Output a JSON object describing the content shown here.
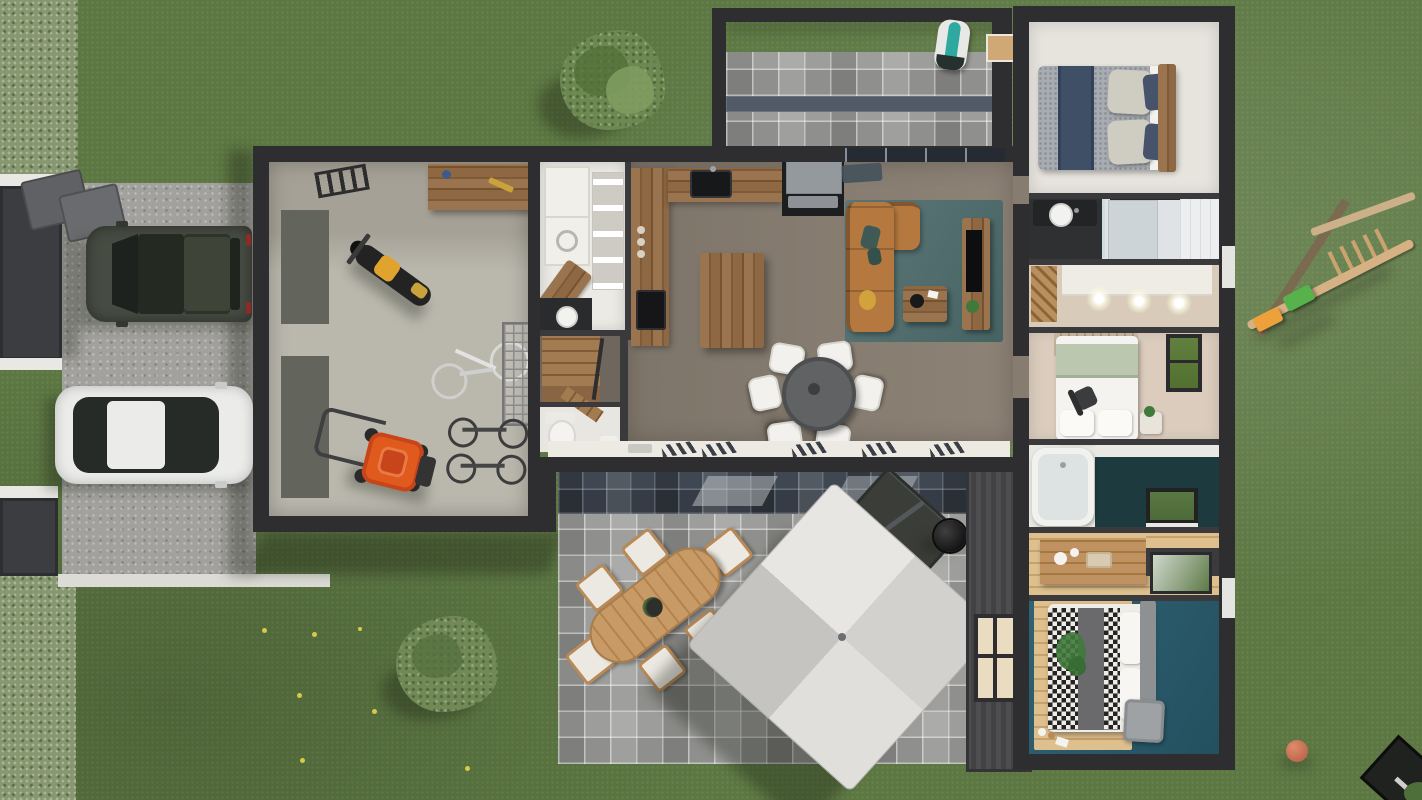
{
  "scene": {
    "title": "Top-down 3D architectural rendering of a single-storey house with garage, garden, driveway and patios",
    "view": "bird's-eye photorealistic render",
    "labels": {
      "lawn": "Lawn with dandelions",
      "hedge": "Boundary hedge",
      "driveway": "Gravel driveway",
      "gateUpper": "Upper driveway gate",
      "gateLower": "Lower driveway gate",
      "trashBins": "Waste bins",
      "suv": "Dark SUV parked on driveway",
      "whiteCar": "White sedan parked on driveway",
      "tree": "Round garden tree",
      "shrub": "Garden shrub",
      "garage": "Garage",
      "motorcycle": "Yellow motorcycle",
      "bicycle": "Bicycle lying on garage floor",
      "bikes": "Parked bicycles",
      "rack": "Wire storage rack",
      "workbench": "Garage workbench",
      "ladder": "Wall-mounted ladder",
      "mower": "Orange lawnmower",
      "utility": "Utility / laundry room",
      "washer": "Washing machine",
      "dryer": "Dryer",
      "kitchen": "Kitchen",
      "island": "Kitchen island",
      "diningTable": "Indoor dining table with six white chairs",
      "living": "Living room",
      "sofa": "Cognac leather corner sofa",
      "rug": "Teal area rug",
      "coffeeTable": "Wooden coffee table",
      "tvUnit": "TV media unit",
      "wc": "Guest WC",
      "stairs": "Staircase",
      "pergola": "Pergola terrace",
      "robotMower": "Robot lawn mower with charging dock",
      "patio": "South paver patio",
      "patioDining": "Outdoor oval dining table with six chairs",
      "umbrella": "Cantilever patio umbrella",
      "lounge": "Outdoor lounge set",
      "grill": "Barbecue grill",
      "bedroom1": "Bedroom 1 with double bed",
      "shower": "Shower room",
      "dressing1": "Dressing with spotlights",
      "bedroom2": "Bedroom 2",
      "bathroom": "Bathroom with bathtub",
      "dressing2": "Walk-in closet",
      "master": "Master bedroom",
      "swing": "Wooden swing set",
      "ball": "Red ball on lawn",
      "gardenTable": "Garden furniture in corner"
    }
  },
  "palette": {
    "grass": "#5c7742",
    "hedge": "#879870",
    "gravel": "#a2a19d",
    "wall": "#2e2d2f",
    "innerwall": "#3a393c",
    "garageFloor": "#bab8ad",
    "floorMain": "#867c70",
    "floorWhite": "#e7e4de",
    "floorBeige": "#d9cbbb",
    "bathTeal": "#1d3b3e",
    "masterTeal": "#2b5c6d",
    "sofa": "#b5793f",
    "rug": "#557170",
    "umbrella": "#d8d7d4",
    "suv": "#474c43",
    "carWhite": "#ebecea",
    "mowerOrange": "#e05a1e",
    "motoYellow": "#e0a32e",
    "robotTeal": "#2fa8a0",
    "ballRed": "#bf6a50",
    "swingGreen": "#58b24c",
    "swingOrange": "#eda13a",
    "glassDark": "#262b33",
    "bedNavy": "#3e4f66",
    "bedGray": "#a7acb2",
    "bedGreen": "#bcc7b0"
  }
}
